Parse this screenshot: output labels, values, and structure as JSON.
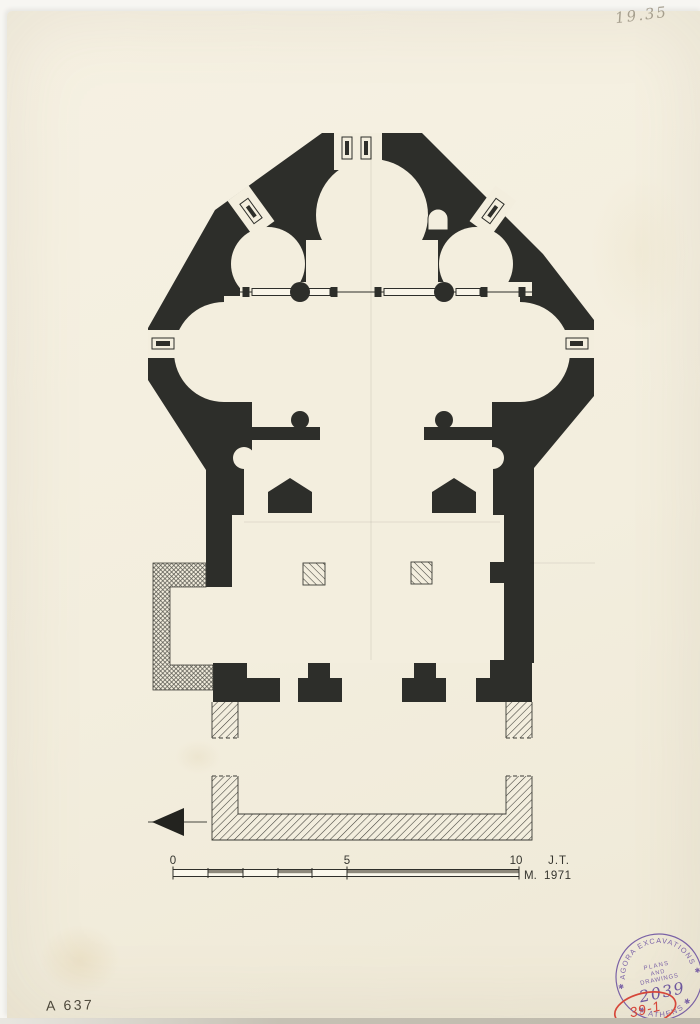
{
  "drawing": {
    "subject": "church-floor-plan",
    "phases": {
      "solid_walls": "original church walls",
      "diagonal_hatch_walls": "later porch walls",
      "cross_hatch_wall": "buttress annex wall"
    }
  },
  "annotations": {
    "pencil_note_top_right": "19.35",
    "catalog_number": "A 637",
    "red_inventory_mark": "39-1"
  },
  "scale_bar": {
    "tick_0": "0",
    "tick_5": "5",
    "tick_10": "10",
    "unit": "M.",
    "initials": "J.T.",
    "year": "1971"
  },
  "stamp": {
    "arc_top": "AGORA EXCAVATIONS",
    "arc_bottom": "✱ ATHENS ✱",
    "star": "✱",
    "line1": "PLANS",
    "line2": "AND",
    "line3": "DRAWINGS",
    "number": "2039"
  },
  "colors": {
    "paper": "#f3eede",
    "ink": "#2d2e2a",
    "stamp_purple": "#6b50a0",
    "red_mark": "#d6473a",
    "pencil": "#948c7a"
  }
}
